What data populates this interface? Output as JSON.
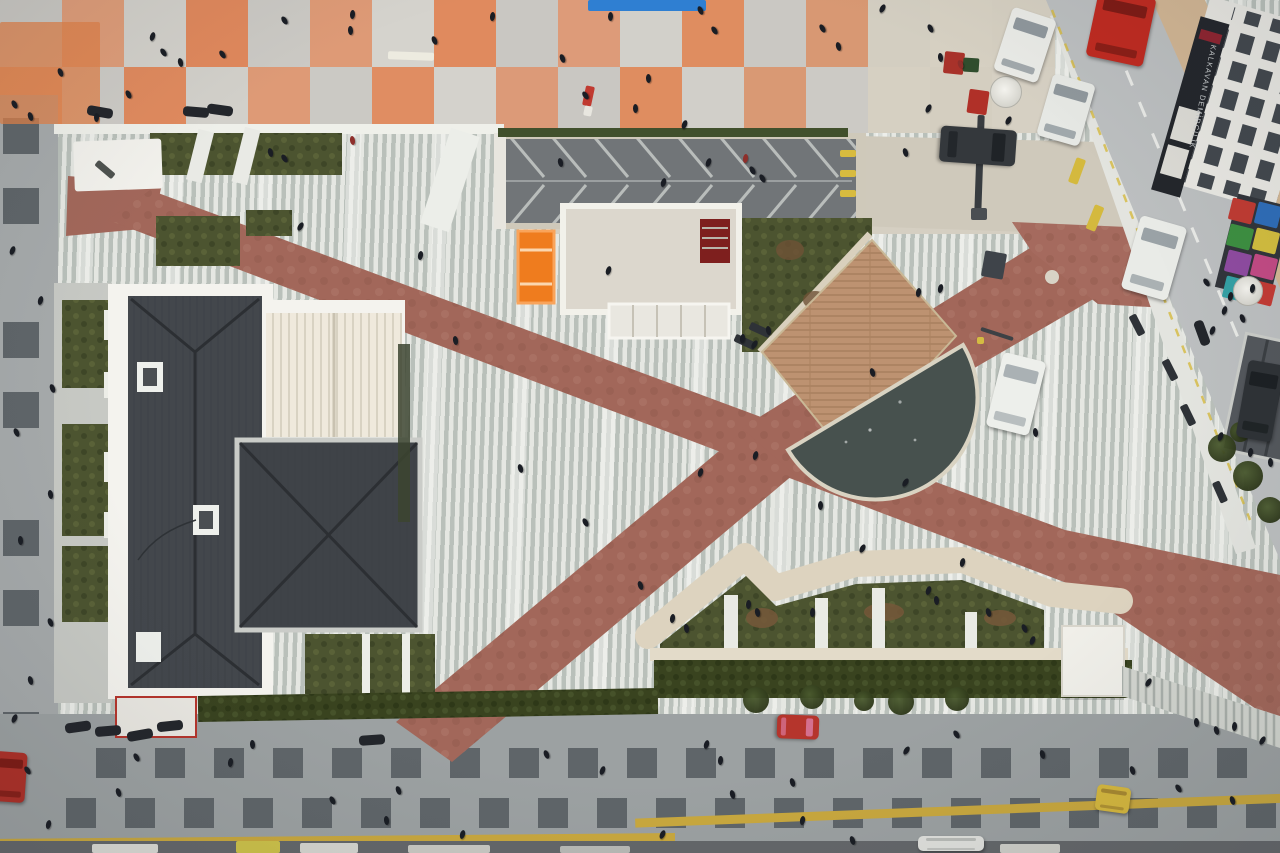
{
  "storefront_sign": {
    "text": "KALKAVAN DEMİRCİLİK"
  },
  "palette": {
    "plaza_stripe_dark": "#b9c0ba",
    "plaza_stripe_light": "#e5e7e2",
    "path_red": "#a2675a",
    "roof_dark": "#43474c",
    "water": "#47514e",
    "deck_wood": "#bd9271",
    "garden_green": "#4c5430",
    "hedge_green": "#39431f",
    "street_gray": "#9ca1a2",
    "street_square": "#5f6569",
    "tactile_yellow": "#c9a83e",
    "salmon_tile": "#dd9b79",
    "road_gray": "#bcbfc0",
    "people_color": "#1a1d24",
    "orange_kiosk": "#ef7c1e",
    "stone_beige": "#d9d0bd"
  },
  "top_street": {
    "tile_w": 62,
    "tile_h": 66.5,
    "rows": [
      [
        "#cac8c3",
        "#df9d79",
        "#d3d1cb",
        "#e0885c",
        "#cbc9c4",
        "#de9a76",
        "#d5d3cd",
        "#e08a5e",
        "#c9c7c2",
        "#dd9b79",
        "#d2d0ca",
        "#df8d60",
        "#cac8c3",
        "#d89873",
        "#d3cec1",
        "#d6d0c2",
        "#d5cfc1"
      ],
      [
        "#dd9b79",
        "#cdcbc6",
        "#e08a5e",
        "#d2d0ca",
        "#de9a76",
        "#cbc9c4",
        "#e08d62",
        "#d4d2cc",
        "#dc9a78",
        "#c9c7c2",
        "#df8d60",
        "#d1cfc9",
        "#d99974",
        "#cccac5",
        "#d6d0c2",
        "#d4cec0",
        "#d6d0c3"
      ]
    ]
  },
  "bottom_street": {
    "square": 30,
    "row1_y": 748,
    "row2_y": 798,
    "row1_xs": [
      96,
      155,
      214,
      273,
      332,
      391,
      450,
      509,
      568,
      627,
      686,
      745,
      804,
      863,
      922,
      981,
      1040,
      1099,
      1158,
      1217
    ],
    "row2_xs": [
      66,
      125,
      184,
      243,
      302,
      361,
      420,
      479,
      538,
      597,
      656,
      715,
      774,
      833,
      892,
      951,
      1010,
      1069,
      1128,
      1187,
      1246
    ],
    "strips": [
      {
        "x": -5,
        "y": 122,
        "w": 680,
        "h": 8,
        "rot": -0.5
      },
      {
        "x": 635,
        "y": 92,
        "w": 660,
        "h": 9,
        "rot": -2.2
      }
    ]
  },
  "left_street": {
    "square": 36,
    "x": 3,
    "ys": [
      118,
      188,
      322,
      392,
      520,
      590,
      712,
      782
    ]
  },
  "people": [
    [
      14,
      104
    ],
    [
      30,
      116
    ],
    [
      60,
      72
    ],
    [
      96,
      117
    ],
    [
      128,
      94
    ],
    [
      152,
      36
    ],
    [
      163,
      52
    ],
    [
      180,
      62
    ],
    [
      222,
      54
    ],
    [
      284,
      20
    ],
    [
      352,
      14
    ],
    [
      350,
      30
    ],
    [
      434,
      40
    ],
    [
      492,
      16
    ],
    [
      562,
      58
    ],
    [
      610,
      16
    ],
    [
      648,
      78
    ],
    [
      700,
      10
    ],
    [
      714,
      30
    ],
    [
      822,
      28
    ],
    [
      838,
      46
    ],
    [
      882,
      8
    ],
    [
      930,
      28
    ],
    [
      960,
      64,
      "#8e2f2b"
    ],
    [
      940,
      57
    ],
    [
      635,
      108
    ],
    [
      585,
      95
    ],
    [
      270,
      152
    ],
    [
      284,
      158
    ],
    [
      352,
      140,
      "#8e2f2b"
    ],
    [
      300,
      226
    ],
    [
      420,
      255
    ],
    [
      560,
      162
    ],
    [
      684,
      124
    ],
    [
      708,
      162
    ],
    [
      745,
      158,
      "#8e2f2b"
    ],
    [
      752,
      170
    ],
    [
      762,
      178
    ],
    [
      742,
      338
    ],
    [
      754,
      344
    ],
    [
      768,
      330
    ],
    [
      700,
      472
    ],
    [
      640,
      585
    ],
    [
      520,
      468
    ],
    [
      585,
      522
    ],
    [
      455,
      340
    ],
    [
      820,
      505
    ],
    [
      862,
      548
    ],
    [
      905,
      482
    ],
    [
      962,
      562
    ],
    [
      988,
      612
    ],
    [
      755,
      455
    ],
    [
      872,
      372
    ],
    [
      940,
      288
    ],
    [
      918,
      292
    ],
    [
      1035,
      432
    ],
    [
      608,
      270
    ],
    [
      663,
      182
    ],
    [
      672,
      618
    ],
    [
      686,
      628
    ],
    [
      748,
      604
    ],
    [
      757,
      612
    ],
    [
      812,
      612
    ],
    [
      928,
      590
    ],
    [
      936,
      600
    ],
    [
      1024,
      628
    ],
    [
      1032,
      640
    ],
    [
      1148,
      682
    ],
    [
      27,
      770
    ],
    [
      48,
      824
    ],
    [
      118,
      792
    ],
    [
      136,
      757
    ],
    [
      230,
      762
    ],
    [
      252,
      744
    ],
    [
      332,
      800
    ],
    [
      386,
      820
    ],
    [
      398,
      790
    ],
    [
      462,
      834
    ],
    [
      546,
      754
    ],
    [
      602,
      770
    ],
    [
      706,
      744
    ],
    [
      720,
      760
    ],
    [
      732,
      794
    ],
    [
      792,
      782
    ],
    [
      802,
      820
    ],
    [
      906,
      750
    ],
    [
      956,
      734
    ],
    [
      1042,
      754
    ],
    [
      1132,
      770
    ],
    [
      1178,
      788
    ],
    [
      1232,
      800
    ],
    [
      1262,
      740
    ],
    [
      662,
      834
    ],
    [
      852,
      840
    ],
    [
      1196,
      722
    ],
    [
      1216,
      730
    ],
    [
      1234,
      726
    ],
    [
      12,
      250
    ],
    [
      40,
      300
    ],
    [
      52,
      388
    ],
    [
      16,
      432
    ],
    [
      50,
      494
    ],
    [
      20,
      540
    ],
    [
      50,
      622
    ],
    [
      30,
      680
    ],
    [
      14,
      718
    ],
    [
      1206,
      282
    ],
    [
      1230,
      296
    ],
    [
      1252,
      288
    ],
    [
      1224,
      310
    ],
    [
      1242,
      318
    ],
    [
      1212,
      330
    ],
    [
      1220,
      436
    ],
    [
      1250,
      452
    ],
    [
      1270,
      462
    ],
    [
      905,
      152
    ],
    [
      928,
      108
    ],
    [
      1008,
      120
    ]
  ],
  "motos": [
    [
      100,
      112,
      10
    ],
    [
      196,
      112,
      5
    ],
    [
      220,
      110,
      8
    ],
    [
      78,
      727,
      -8
    ],
    [
      108,
      731,
      -5
    ],
    [
      140,
      735,
      -10
    ],
    [
      170,
      726,
      -6
    ],
    [
      372,
      740,
      -4
    ],
    [
      1202,
      333,
      70
    ]
  ],
  "cars": [
    {
      "name": "white-sedan-a",
      "x": 1002,
      "y": 12,
      "w": 46,
      "h": 66,
      "rot": 18,
      "body": "#e9eae6",
      "glass": "#8f979c"
    },
    {
      "name": "white-sedan-b",
      "x": 1044,
      "y": 78,
      "w": 44,
      "h": 64,
      "rot": 16,
      "body": "#e6e8e4",
      "glass": "#8f979c"
    },
    {
      "name": "dark-sedan",
      "x": 960,
      "y": 108,
      "w": 36,
      "h": 76,
      "rot": 94,
      "body": "#34383c",
      "glass": "#1f2327"
    },
    {
      "name": "white-sedan-c",
      "x": 1130,
      "y": 220,
      "w": 48,
      "h": 76,
      "rot": 16,
      "body": "#e9ebe7",
      "glass": "#9aa2a6"
    },
    {
      "name": "red-truck",
      "x": 1092,
      "y": -8,
      "w": 58,
      "h": 70,
      "rot": 12,
      "body": "#bf2a20",
      "glass": "#7e1a14"
    },
    {
      "name": "white-van-plaza",
      "x": 994,
      "y": 356,
      "w": 44,
      "h": 76,
      "rot": 14,
      "body": "#edefeb",
      "glass": "#aab1b4"
    },
    {
      "name": "dark-car-right",
      "x": 1242,
      "y": 362,
      "w": 36,
      "h": 78,
      "rot": 10,
      "body": "#2e3236",
      "glass": "#1c2023"
    },
    {
      "name": "red-cart",
      "x": 786,
      "y": 706,
      "w": 24,
      "h": 42,
      "rot": 92,
      "body": "#b5352c",
      "glass": "#d4708f"
    },
    {
      "name": "yellow-cart",
      "x": 1096,
      "y": 786,
      "w": 34,
      "h": 26,
      "rot": 8,
      "body": "#d6b83e",
      "glass": "#a88930"
    },
    {
      "name": "white-cart",
      "x": 918,
      "y": 836,
      "w": 66,
      "h": 15,
      "rot": 0,
      "body": "#e0e1dd",
      "glass": "#b9bcb8"
    },
    {
      "name": "red-vehicle-left",
      "x": -6,
      "y": 752,
      "w": 32,
      "h": 50,
      "rot": 4,
      "body": "#ae2f27",
      "glass": "#7e1a14"
    }
  ],
  "benches": [
    [
      1137,
      325,
      63
    ],
    [
      1170,
      370,
      63
    ],
    [
      1188,
      415,
      64
    ],
    [
      1220,
      492,
      66
    ],
    [
      745,
      342,
      25
    ],
    [
      760,
      330,
      25
    ]
  ],
  "trees": [
    [
      756,
      700,
      13
    ],
    [
      812,
      697,
      12
    ],
    [
      901,
      702,
      13
    ],
    [
      957,
      699,
      12
    ],
    [
      864,
      701,
      10
    ],
    [
      1222,
      448,
      14
    ],
    [
      1248,
      476,
      15
    ],
    [
      1270,
      510,
      13
    ],
    [
      1240,
      432,
      10
    ]
  ],
  "umbrellas": [
    [
      1006,
      92,
      16
    ],
    [
      1248,
      291,
      15
    ]
  ],
  "rects": [
    {
      "x": 588,
      "y": 0,
      "w": 118,
      "h": 11,
      "rot": 0,
      "c": "#2f7fd2"
    },
    {
      "x": 388,
      "y": 52,
      "w": 46,
      "h": 8,
      "rot": 2,
      "c": "#edebe0"
    },
    {
      "x": 0,
      "y": 22,
      "w": 100,
      "h": 102,
      "rot": 0,
      "c": "rgba(224,130,74,0.75)"
    },
    {
      "x": 944,
      "y": 52,
      "w": 20,
      "h": 22,
      "rot": 6,
      "c": "#a8322a"
    },
    {
      "x": 963,
      "y": 58,
      "w": 16,
      "h": 14,
      "rot": 4,
      "c": "#2f4d2d"
    },
    {
      "x": 968,
      "y": 90,
      "w": 20,
      "h": 24,
      "rot": 8,
      "c": "#b03028"
    },
    {
      "x": 976,
      "y": 115,
      "w": 7,
      "h": 98,
      "rot": 2,
      "c": "#383c40"
    },
    {
      "x": 971,
      "y": 208,
      "w": 16,
      "h": 12,
      "rot": 0,
      "c": "#4a4e52"
    },
    {
      "x": 584,
      "y": 86,
      "w": 9,
      "h": 20,
      "rot": 12,
      "c": "#c03a30"
    },
    {
      "x": 584,
      "y": 106,
      "w": 8,
      "h": 10,
      "rot": 12,
      "c": "#e8e6df"
    },
    {
      "x": 983,
      "y": 252,
      "w": 22,
      "h": 26,
      "rot": 10,
      "c": "#3f444a"
    },
    {
      "x": 840,
      "y": 150,
      "w": 16,
      "h": 7,
      "rot": 0,
      "c": "#d8bb3f"
    },
    {
      "x": 840,
      "y": 170,
      "w": 16,
      "h": 7,
      "rot": 0,
      "c": "#d8bb3f"
    },
    {
      "x": 840,
      "y": 190,
      "w": 16,
      "h": 7,
      "rot": 0,
      "c": "#d8bb3f"
    },
    {
      "x": 1072,
      "y": 158,
      "w": 10,
      "h": 26,
      "rot": 20,
      "c": "#d4b93e"
    },
    {
      "x": 1090,
      "y": 205,
      "w": 10,
      "h": 26,
      "rot": 22,
      "c": "#d4b93e"
    },
    {
      "x": 980,
      "y": 332,
      "w": 34,
      "h": 4,
      "rot": 18,
      "c": "#3d4145"
    },
    {
      "x": 977,
      "y": 337,
      "w": 7,
      "h": 7,
      "rot": 0,
      "c": "#d4bc42"
    },
    {
      "x": 94,
      "y": 166,
      "w": 22,
      "h": 7,
      "rot": 40,
      "c": "#4e524f"
    },
    {
      "x": 92,
      "y": 844,
      "w": 66,
      "h": 9,
      "rot": 0,
      "c": "#dcdcd6"
    },
    {
      "x": 300,
      "y": 843,
      "w": 58,
      "h": 10,
      "rot": 0,
      "c": "#d6d6d0"
    },
    {
      "x": 408,
      "y": 845,
      "w": 82,
      "h": 8,
      "rot": 0,
      "c": "#c9c9c3"
    },
    {
      "x": 560,
      "y": 846,
      "w": 70,
      "h": 7,
      "rot": 0,
      "c": "#b9bab6"
    },
    {
      "x": 1000,
      "y": 844,
      "w": 60,
      "h": 9,
      "rot": 0,
      "c": "#cfcfc9"
    },
    {
      "x": 236,
      "y": 841,
      "w": 44,
      "h": 12,
      "rot": 0,
      "c": "#cdc24a"
    },
    {
      "x": 1230,
      "y": 200,
      "w": 24,
      "h": 22,
      "rot": 14,
      "c": "#bf3a32"
    },
    {
      "x": 1256,
      "y": 204,
      "w": 24,
      "h": 22,
      "rot": 14,
      "c": "#2e6db8"
    },
    {
      "x": 1228,
      "y": 226,
      "w": 24,
      "h": 22,
      "rot": 14,
      "c": "#3d8f41"
    },
    {
      "x": 1254,
      "y": 230,
      "w": 24,
      "h": 22,
      "rot": 14,
      "c": "#d2bd3e"
    },
    {
      "x": 1226,
      "y": 252,
      "w": 24,
      "h": 22,
      "rot": 14,
      "c": "#8e4ba0"
    },
    {
      "x": 1252,
      "y": 256,
      "w": 24,
      "h": 22,
      "rot": 14,
      "c": "#c24a84"
    },
    {
      "x": 1224,
      "y": 278,
      "w": 24,
      "h": 22,
      "rot": 14,
      "c": "#34a0a4"
    },
    {
      "x": 1250,
      "y": 282,
      "w": 24,
      "h": 22,
      "rot": 14,
      "c": "#c23b34"
    }
  ]
}
